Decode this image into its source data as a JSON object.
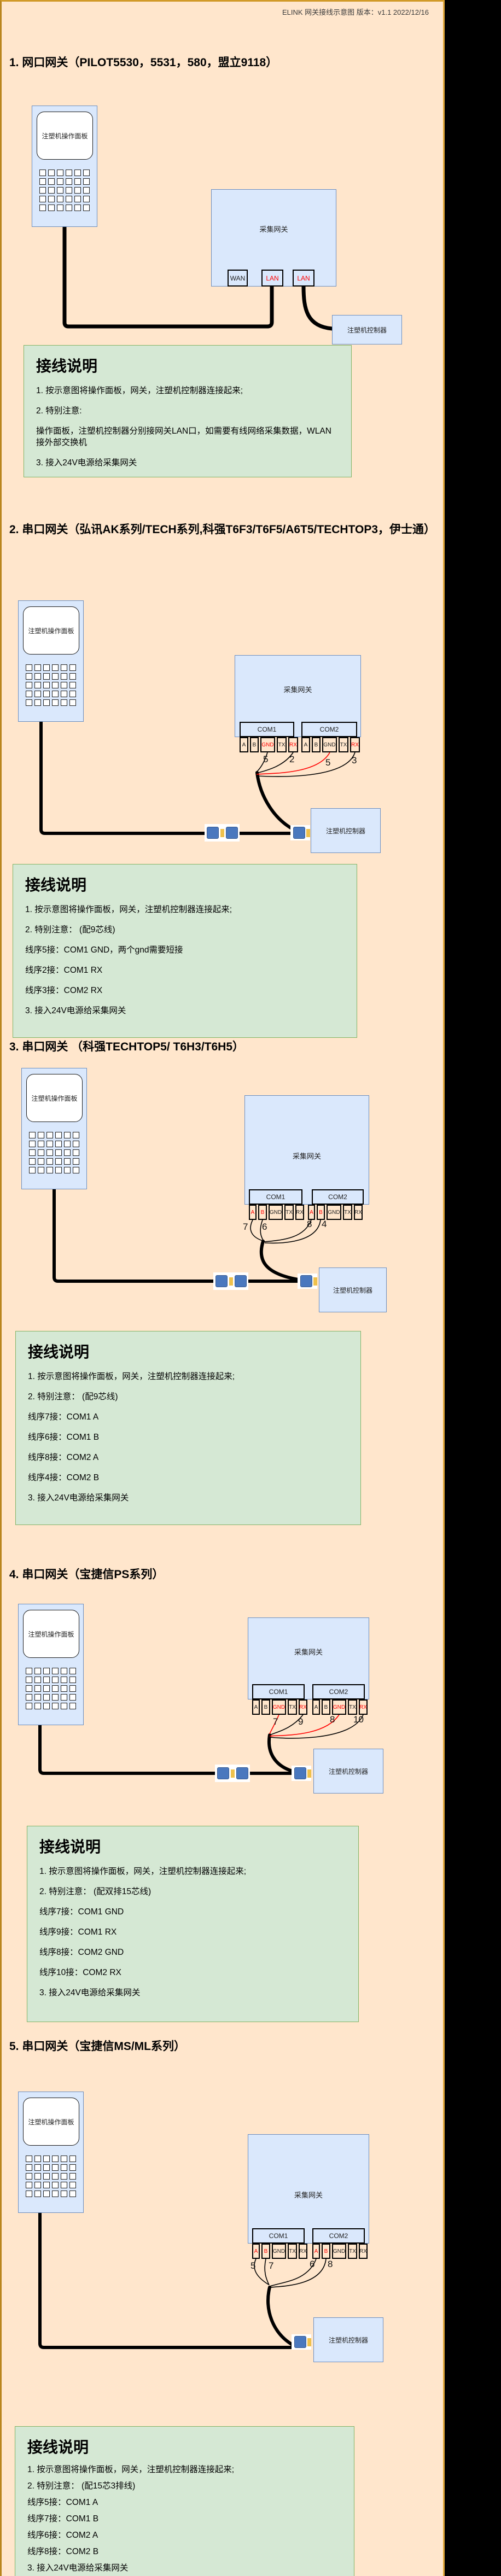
{
  "header": {
    "text": "ELINK 网关接线示意图 版本：v1.1 2022/12/16"
  },
  "colors": {
    "page_background": "#ffe6cc",
    "frame_border": "#d19a28",
    "box_fill": "#dae8fc",
    "box_border": "#6c8ebf",
    "note_fill": "#d5e8d4",
    "note_border": "#82b366",
    "highlight_red": "#ff0000",
    "cable_black": "#000000",
    "side_strip": "#000000"
  },
  "common": {
    "device_label": "注塑机操作面板",
    "gateway_label": "采集网关",
    "controller_label": "注塑机控制器",
    "note_title": "接线说明",
    "com1_label": "COM1",
    "com2_label": "COM2",
    "pins": [
      "A",
      "B",
      "GND",
      "TX",
      "RX"
    ]
  },
  "sections": [
    {
      "title": "1. 网口网关（PILOT5530，5531，580，盟立9118）",
      "ports": [
        "WAN",
        "LAN",
        "LAN"
      ],
      "instructions": [
        "1. 按示意图将操作面板，网关，注塑机控制器连接起来;",
        "2. 特别注意:",
        "操作面板，注塑机控制器分别接网关LAN口，如需要有线网络采集数据，WLAN接外部交换机",
        "3. 接入24V电源给采集网关"
      ]
    },
    {
      "title": "2. 串口网关（弘讯AK系列/TECH系列,科强T6F3/T6F5/A6T5/TECHTOP3，伊士通）",
      "wire_labels": [
        "5",
        "2",
        "5",
        "3"
      ],
      "instructions": [
        "1. 按示意图将操作面板，网关，注塑机控制器连接起来;",
        "2. 特别注意： (配9芯线)",
        "线序5接：COM1 GND，两个gnd需要短接",
        "线序2接：COM1 RX",
        "线序3接：COM2 RX",
        "3. 接入24V电源给采集网关"
      ]
    },
    {
      "title": "3. 串口网关 （科强TECHTOP5/ T6H3/T6H5）",
      "wire_labels": [
        "7",
        "6",
        "8",
        "4"
      ],
      "instructions": [
        "1. 按示意图将操作面板，网关，注塑机控制器连接起来;",
        "2. 特别注意： (配9芯线)",
        "线序7接：COM1 A",
        "线序6接：COM1 B",
        "线序8接：COM2 A",
        "线序4接：COM2 B",
        "3. 接入24V电源给采集网关"
      ]
    },
    {
      "title": "4. 串口网关（宝捷信PS系列）",
      "wire_labels": [
        "7",
        "9",
        "8",
        "10"
      ],
      "instructions": [
        "1. 按示意图将操作面板，网关，注塑机控制器连接起来;",
        "2. 特别注意： (配双排15芯线)",
        "线序7接：COM1 GND",
        "线序9接：COM1 RX",
        "线序8接：COM2 GND",
        "线序10接：COM2 RX",
        "3. 接入24V电源给采集网关"
      ]
    },
    {
      "title": "5. 串口网关（宝捷信MS/ML系列）",
      "wire_labels": [
        "5",
        "7",
        "6",
        "8"
      ],
      "instructions": [
        "1. 按示意图将操作面板，网关，注塑机控制器连接起来;",
        "2. 特别注意： (配15芯3排线)",
        "线序5接：COM1 A",
        "线序7接：COM1 B",
        "线序6接：COM2 A",
        "线序8接：COM2 B",
        "3. 接入24V电源给采集网关"
      ]
    }
  ]
}
